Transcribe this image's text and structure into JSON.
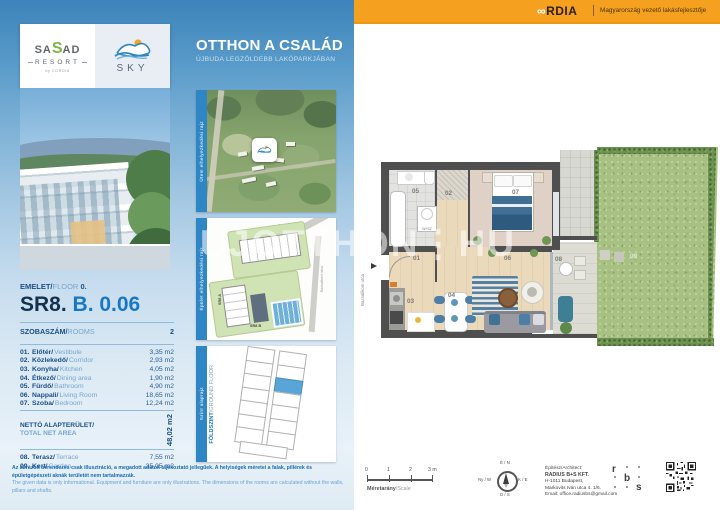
{
  "cordia": {
    "symbol": "∞",
    "name": "RDIA",
    "tagline": "Magyarország vezető lakásfejlesztője"
  },
  "brand": {
    "sasad": {
      "pre": "SA",
      "s": "S",
      "post": "AD",
      "resort": "RESORT",
      "by": "by CORDIA"
    },
    "sky": "SKY"
  },
  "campaign": {
    "title": "OTTHON A CSALÁD",
    "subtitle": "ÚJBUDA LEGZÖLDEBB LAKÓPARKJÁBAN"
  },
  "unit": {
    "floor_hu": "EMELET/",
    "floor_en": "FLOOR",
    "floor_num": "0.",
    "code_main": "SR8.",
    "code_sub": "B. 0.06"
  },
  "table": {
    "rooms_hu": "SZOBASZÁM/",
    "rooms_en": "ROOMS",
    "rooms_count": "2",
    "rows": [
      {
        "n": "01.",
        "hu": "Előtér/",
        "en": "Vestibule",
        "v": "3,35 m2"
      },
      {
        "n": "02.",
        "hu": "Közlekedő/",
        "en": "Corridor",
        "v": "2,93 m2"
      },
      {
        "n": "03.",
        "hu": "Konyha/",
        "en": "Kitchen",
        "v": "4,05 m2"
      },
      {
        "n": "04.",
        "hu": "Étkező/",
        "en": "Dining area",
        "v": "1,90 m2"
      },
      {
        "n": "05.",
        "hu": "Fürdő/",
        "en": "Bathroom",
        "v": "4,90 m2"
      },
      {
        "n": "06.",
        "hu": "Nappali/",
        "en": "Living Room",
        "v": "18,65 m2"
      },
      {
        "n": "07.",
        "hu": "Szoba/",
        "en": "Bedroom",
        "v": "12,24 m2"
      }
    ],
    "net_hu": "NETTÓ ALAPTERÜLET/",
    "net_en": "TOTAL NET AREA",
    "net_v": "48,02 m2",
    "outdoor": [
      {
        "n": "08.",
        "hu": "Terasz/",
        "en": "Terrace",
        "v": "7,55 m2"
      },
      {
        "n": "09.",
        "hu": "Kert/",
        "en": "Garden",
        "v": "35,05 m2"
      }
    ]
  },
  "thumbs": {
    "t1_label": "Ütem elhelyezkedési rajz",
    "t2_label": "Épület elhelyezkedési rajz",
    "t3_label": "Szint alaprajz",
    "t3_floor_hu": "FÖLDSZINT",
    "t3_floor_en": "/GROUND FLOOR",
    "t2_b1": "SR8 A",
    "t2_b2": "SR8 B",
    "t2_street1": "Fagyöngy utca",
    "t2_street2": "Bazsalikom utca"
  },
  "plan": {
    "labels": [
      "01",
      "02",
      "03",
      "04",
      "05",
      "06",
      "07",
      "08",
      "09"
    ],
    "washer": "W+SZ",
    "street": "Bazsalikom utca"
  },
  "watermark": "UJOTTHON⋮HU",
  "disclaimer": {
    "hu": "Az ábrázolt berendezés csak illusztráció, a megadott adatok tájékoztató jellegűek. A helyiségek méretei a falak, pillérek és épületgépészeti aknák területét nem tartalmazzák.",
    "en": "The given data is only informational. Equipment and furniture are only illustrations. The dimensions of the rooms are calculated without the walls, pillars and shafts."
  },
  "footer": {
    "scale_ticks": [
      "0",
      "1",
      "2",
      "3 m"
    ],
    "scale_hu": "Méretarány",
    "scale_en": "/Scale",
    "compass": {
      "n": "É / N",
      "w": "Ny / W",
      "e": "K / E",
      "s": "D / S"
    },
    "architect": {
      "title": "Építész/Architect:",
      "name": "RADIUS B+S KFT.",
      "a1": "H-1011 Budapest,",
      "a2": "Markovits Iván utca 4. 1/6.",
      "email": "Email: office.radiusbs@gmail.com"
    },
    "rbs": [
      "r",
      "b",
      "s"
    ]
  }
}
